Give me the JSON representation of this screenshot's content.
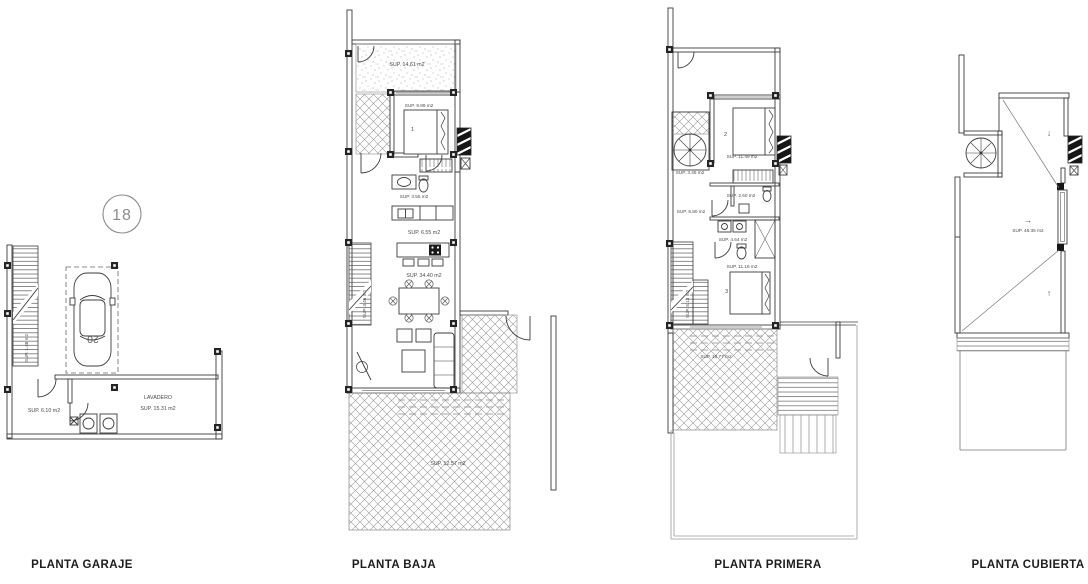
{
  "sheet": {
    "titles": {
      "garaje": "PLANTA GARAJE",
      "baja": "PLANTA BAJA",
      "primera": "PLANTA PRIMERA",
      "cubierta": "PLANTA CUBIERTA"
    },
    "colors": {
      "paper": "#ffffff",
      "ink": "#3c3c3c",
      "hatch": "#8a8a8a",
      "label": "#4a4a4a"
    }
  },
  "garaje": {
    "plot_number": "18",
    "car_number": "20",
    "stair_label": "SUP. 1.48 m2",
    "hall_label": "SUP. 6.10 m2",
    "laundry_name": "LAVADERO",
    "laundry_label": "SUP. 15.31 m2"
  },
  "baja": {
    "patio_label": "SUP. 14.61 m2",
    "bedroom1_label": "SUP. 9.89 m2",
    "bedroom1_number": "1",
    "bath_label": "SUP. 3.55 m2",
    "kitchen_label": "SUP. 6.55 m2",
    "living_label": "SUP. 34.40 m2",
    "stair_label": "SUP. 3.46 m2",
    "terrace_label": "SUP. 12.57 m2"
  },
  "primera": {
    "spiral_label": "SUP. 3.45 m2",
    "bedroom2_number": "2",
    "bedroom2_label": "SUP. 11.49 m2",
    "hall_label": "SUP. 5.80 m2",
    "bath_small_label": "SUP. 2.60 m2",
    "bath_label": "SUP. 4.64 m2",
    "stair_label": "SUP. 5.13 m2",
    "bedroom3_number": "3",
    "bedroom3_label": "SUP. 11.16 m2",
    "terrace_label": "SUP. 18.77 m2"
  },
  "cubierta": {
    "roof_label": "SUP. 46.35 m2",
    "arrow_down": "↓",
    "arrow_right": "→",
    "arrow_up": "↑"
  }
}
